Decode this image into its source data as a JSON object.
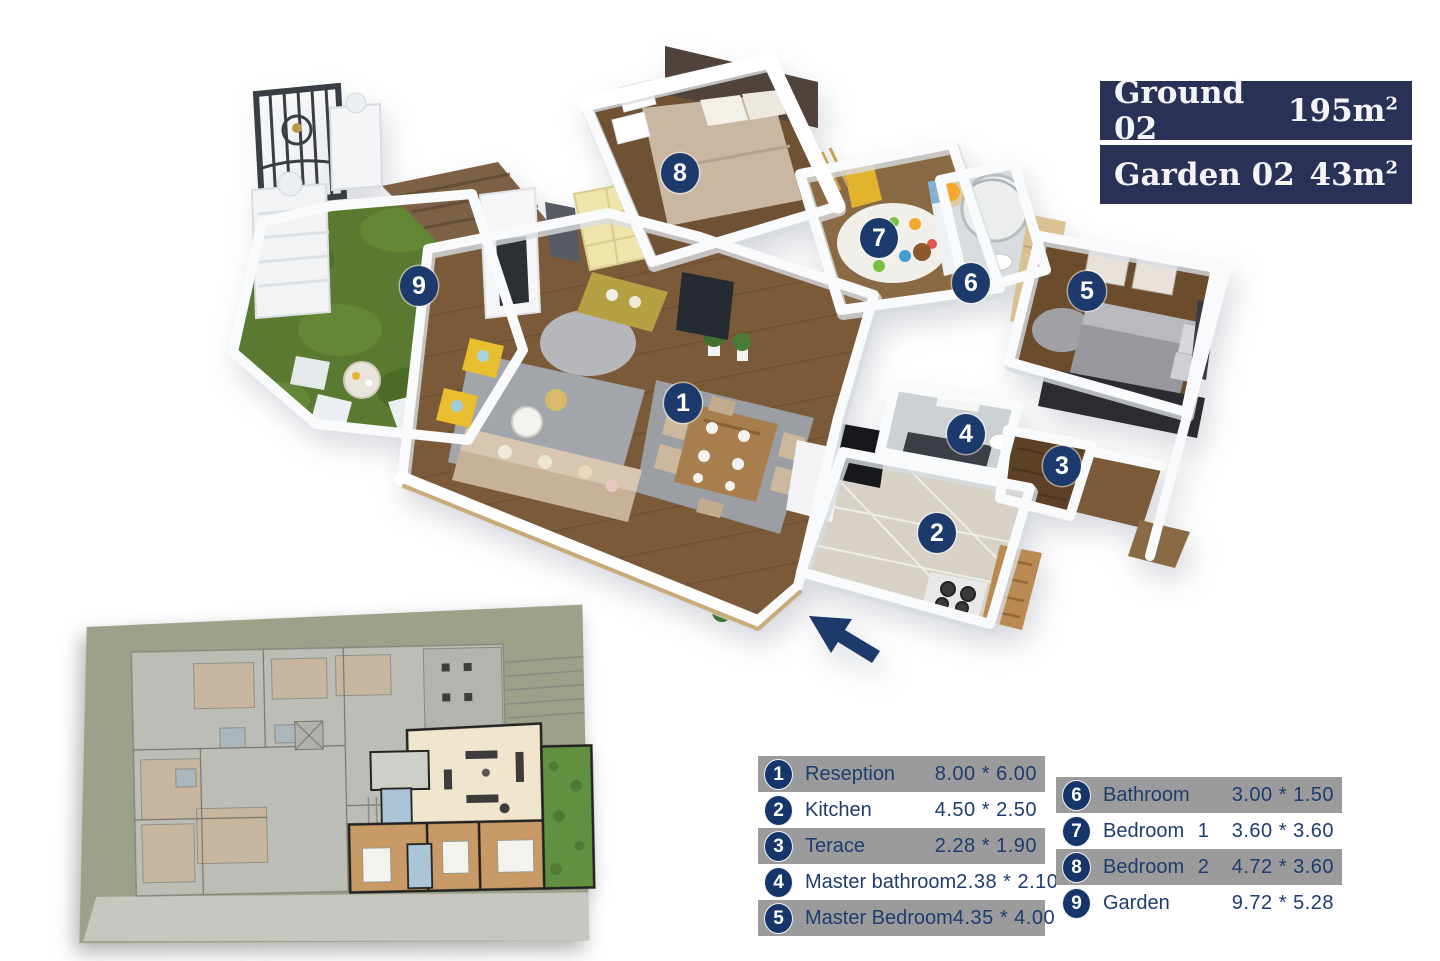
{
  "title_block": {
    "rows": [
      {
        "label": "Ground 02",
        "area": "195m",
        "sup": "2"
      },
      {
        "label": "Garden 02",
        "area": "43m",
        "sup": "2"
      }
    ]
  },
  "floor_plan_3d": {
    "markers": [
      {
        "n": "1",
        "x": 683,
        "y": 403
      },
      {
        "n": "2",
        "x": 937,
        "y": 533
      },
      {
        "n": "3",
        "x": 1062,
        "y": 466
      },
      {
        "n": "4",
        "x": 966,
        "y": 434
      },
      {
        "n": "5",
        "x": 1087,
        "y": 291
      },
      {
        "n": "6",
        "x": 971,
        "y": 283
      },
      {
        "n": "7",
        "x": 879,
        "y": 238
      },
      {
        "n": "8",
        "x": 680,
        "y": 173
      },
      {
        "n": "9",
        "x": 419,
        "y": 286
      }
    ],
    "entrance_arrow": "up-left"
  },
  "legend_left": {
    "rows": [
      {
        "num": "1",
        "name": "Reseption",
        "dims": "8.00 * 6.00"
      },
      {
        "num": "2",
        "name": "Kitchen",
        "dims": "4.50 * 2.50"
      },
      {
        "num": "3",
        "name": "Terace",
        "dims": "2.28 * 1.90"
      },
      {
        "num": "4",
        "name": "Master bathroom",
        "dims": "2.38 * 2.10"
      },
      {
        "num": "5",
        "name": "Master Bedroom",
        "dims": "4.35 * 4.00"
      }
    ]
  },
  "legend_right": {
    "rows": [
      {
        "num": "6",
        "name": "Bathroom",
        "tag": "",
        "dims": "3.00 * 1.50"
      },
      {
        "num": "7",
        "name": "Bedroom",
        "tag": "1",
        "dims": "3.60 * 3.60"
      },
      {
        "num": "8",
        "name": "Bedroom",
        "tag": "2",
        "dims": "4.72 * 3.60"
      },
      {
        "num": "9",
        "name": "Garden",
        "tag": "",
        "dims": "9.72 * 5.28"
      }
    ]
  },
  "colors": {
    "navy_badge": "#1c3a6b",
    "title_bg": "#2a3157",
    "legend_row_gray": "#9b9b9b",
    "legend_text": "#1e3c6e",
    "grass": "#5a7a31",
    "wood_floor": "#7b5a39"
  }
}
